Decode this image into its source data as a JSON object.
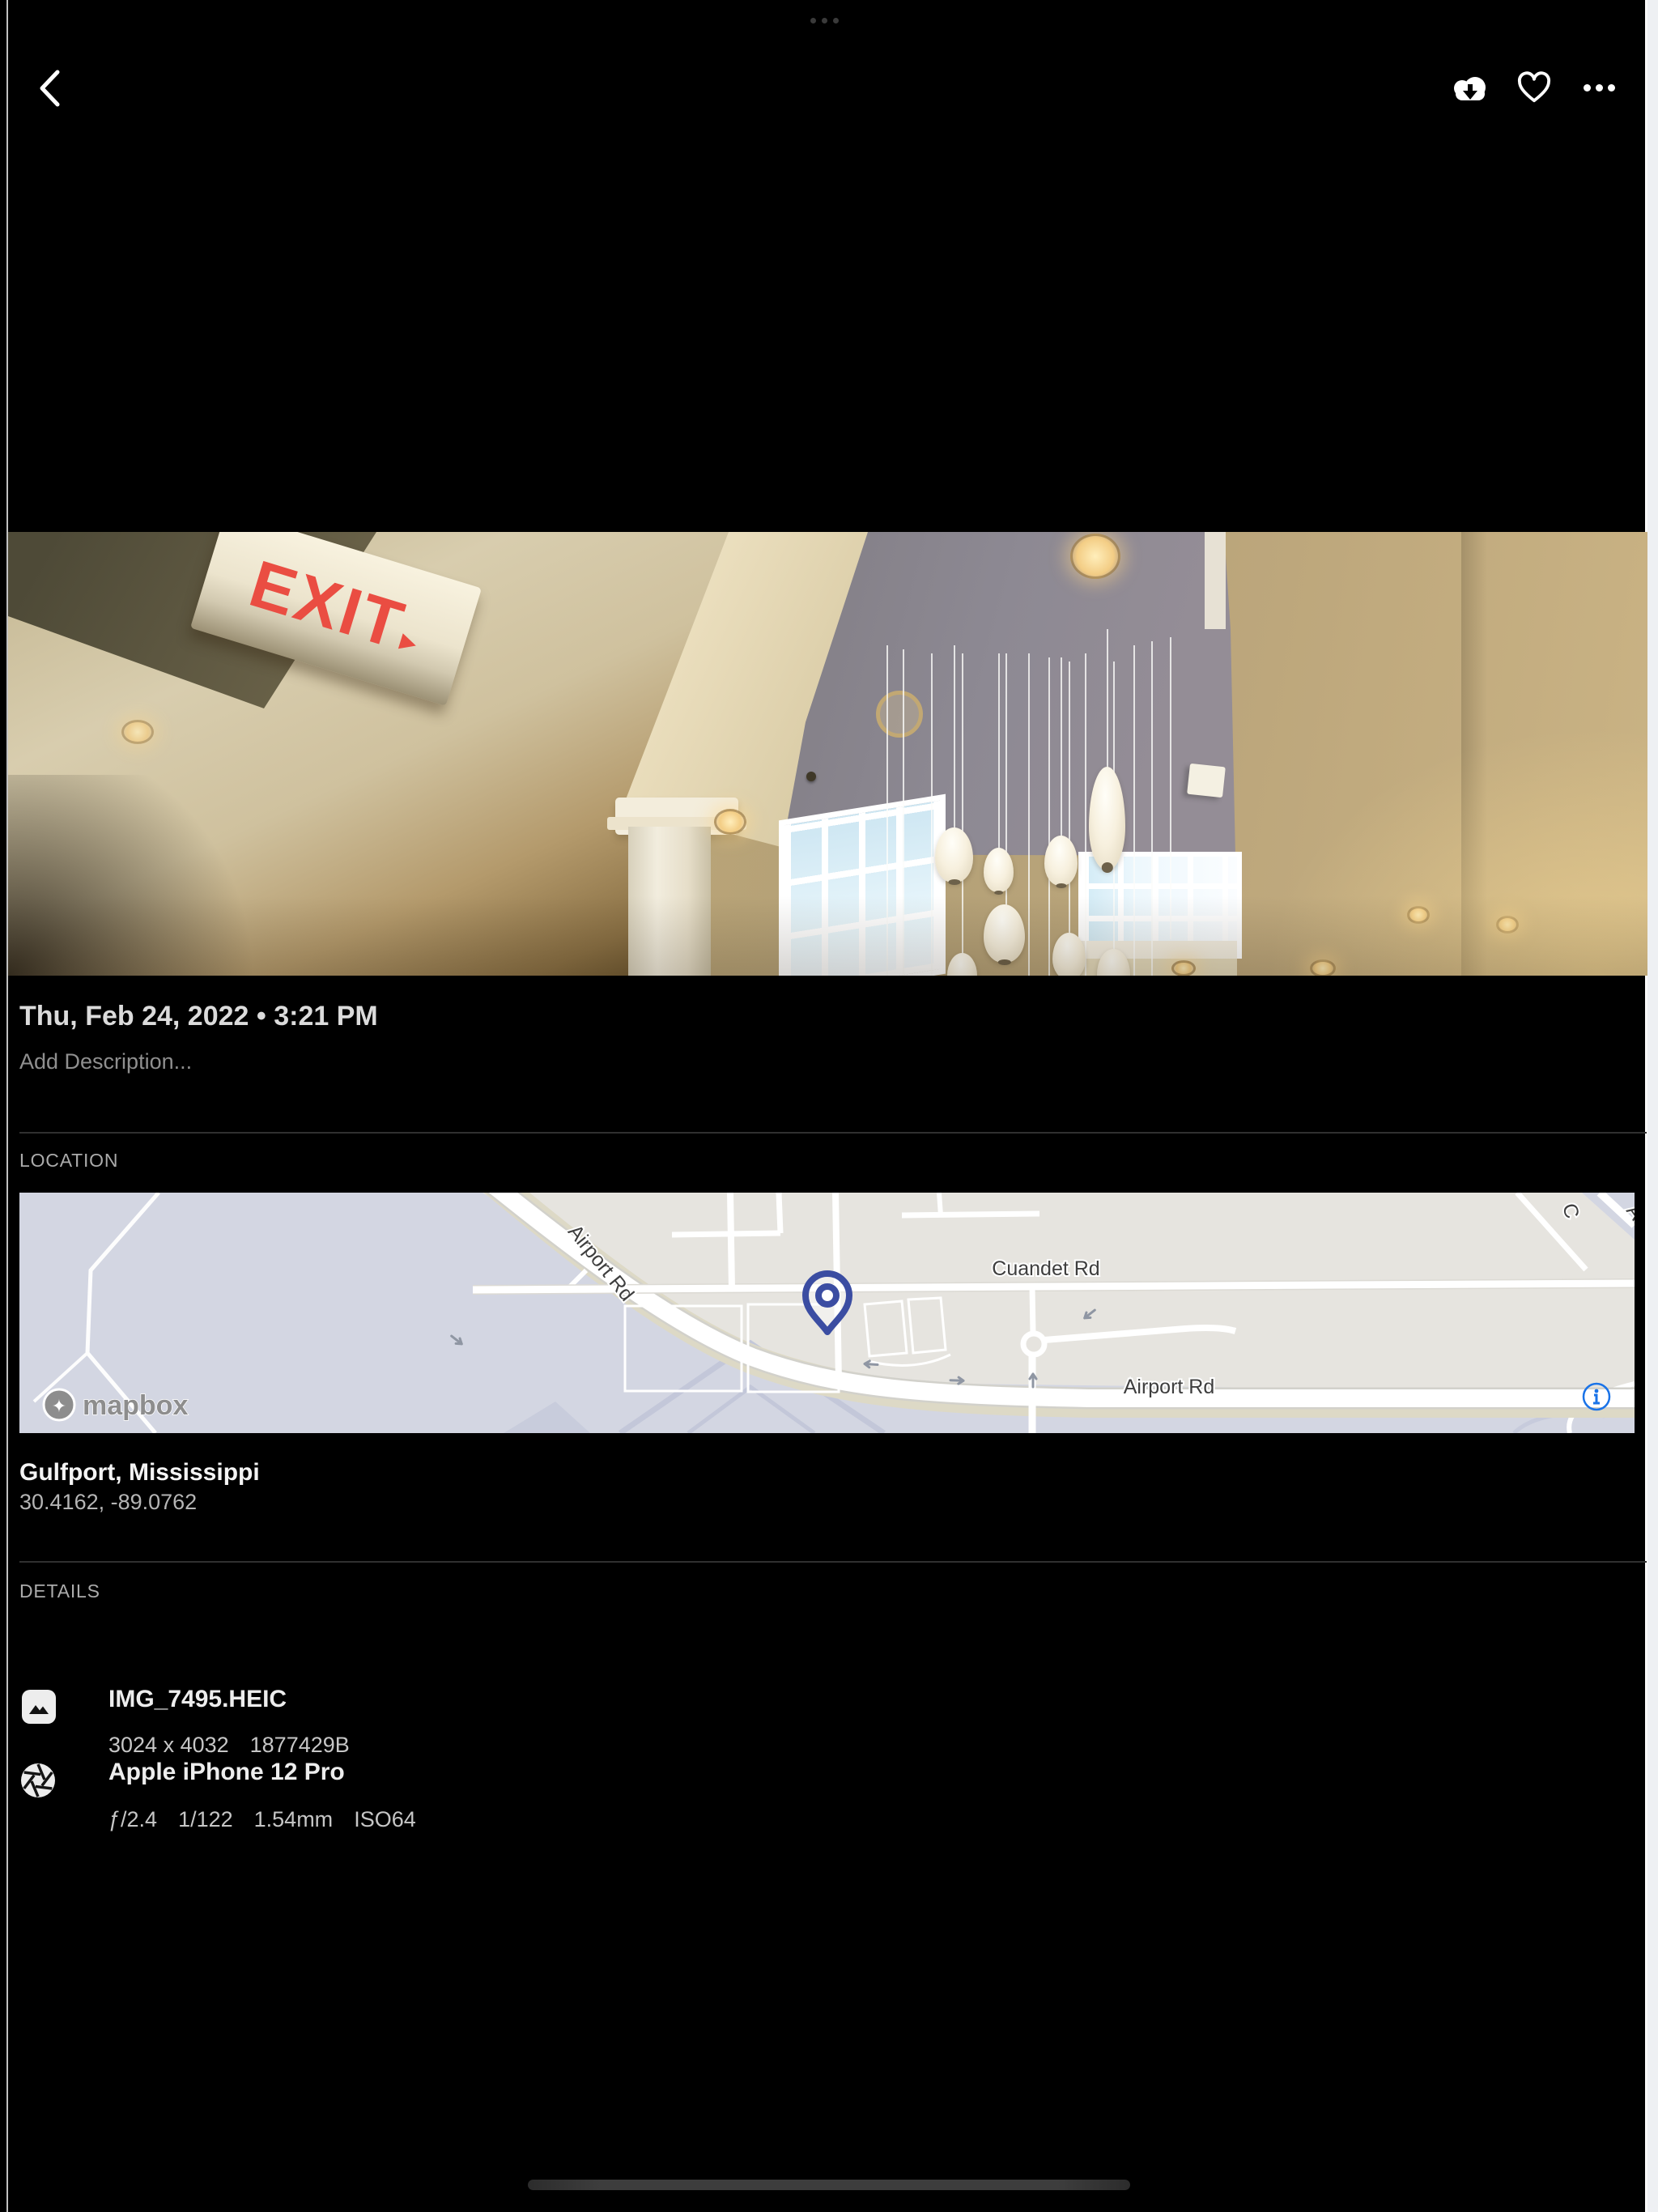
{
  "top_bar": {
    "icons": [
      "chevron-left",
      "cloud-download",
      "heart-outline",
      "ellipsis"
    ]
  },
  "photo": {
    "exit_sign": "EXIT",
    "exit_arrow": "▸"
  },
  "panel": {
    "date": "Thu, Feb 24, 2022 • 3:21 PM",
    "description_placeholder": "Add Description...",
    "location_header": "LOCATION",
    "place": "Gulfport, Mississippi",
    "coordinates": "30.4162, -89.0762",
    "details_header": "DETAILS",
    "file": {
      "title": "IMG_7495.HEIC",
      "meta": [
        "3024 x 4032",
        "1877429B"
      ]
    },
    "camera": {
      "title": "Apple iPhone 12 Pro",
      "meta": [
        "ƒ/2.4",
        "1/122",
        "1.54mm",
        "ISO64"
      ]
    }
  },
  "map": {
    "labels": {
      "road_diagonal": "Airport Rd",
      "road_cuandet": "Cuandet Rd",
      "road_horizontal": "Airport Rd",
      "fragment_a": "C",
      "fragment_b": "Airp"
    },
    "attribution": "mapbox",
    "colors": {
      "pin": "#3b4da2",
      "info_icon": "#1a73e8",
      "land": "#e6e4df",
      "airport_area": "#d3d6e2",
      "road": "#ffffff"
    }
  }
}
